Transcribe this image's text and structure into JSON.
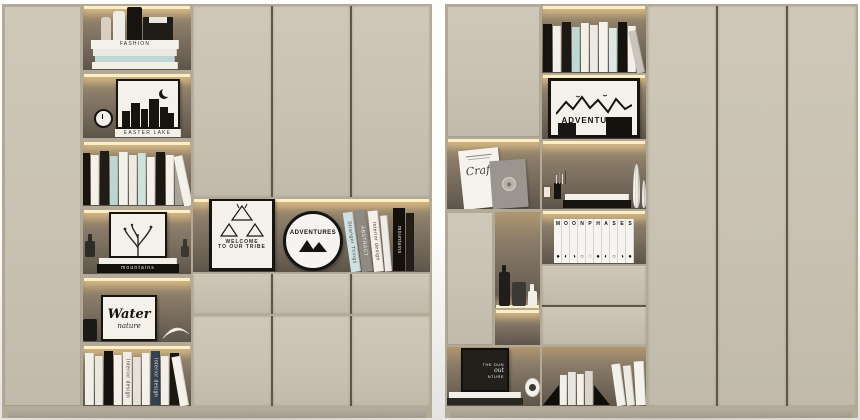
{
  "colors": {
    "bg1": "#fdfdfc",
    "bg2": "#e4e3e1",
    "body_edge": "#b2a996",
    "door": "#c9c2b3",
    "door_hi": "#cfc8b9",
    "door_lo": "#c1baab",
    "gap": "#5e5747",
    "plinth": "#b5ad9e",
    "niche1": "#b0976f",
    "niche2": "#8a7c69",
    "niche3": "#6e6356",
    "niche4": "#5e554a",
    "led": "#ffeec4",
    "ink": "#17130f",
    "paper": "#f4f1eb",
    "teal": "#bfd8d4"
  },
  "scene": {
    "description": "Two beige built-in cabinet units with LED-lit open shelves styled with books and black-and-white decor"
  },
  "texts": {
    "fashion": "FASHION",
    "easter_lake": "EASTER LAKE",
    "mountains": "mountains",
    "water": "Water",
    "nature": "nature",
    "welcome": "WELCOME",
    "to_our_tribe": "TO OUR TRIBE",
    "adventures": "ADVENTURES",
    "craft": "Craft",
    "poster_line1": "THE OUN",
    "poster_line2": "out",
    "poster_line3": "NTURE",
    "moon_row": "M O O N",
    "phases_row": "P H A S E S"
  },
  "left_cabinet": {
    "fashion_stack": [
      {
        "c": "#f5f2ec",
        "h": 9,
        "w": 88,
        "t": "FASHION",
        "tc": "#2e2a25"
      },
      {
        "c": "#ebe8e1",
        "h": 7,
        "w": 84
      },
      {
        "c": "#bfd8d4",
        "h": 6,
        "w": 80
      },
      {
        "c": "#f3f0ea",
        "h": 7,
        "w": 86
      }
    ],
    "easter_spine": [
      {
        "c": "#f3f0ea",
        "h": 8,
        "w": 66,
        "t": "EASTER LAKE",
        "tc": "#35312b"
      }
    ],
    "row3_books": [
      {
        "c": "#17130f",
        "h": 52,
        "w": 9
      },
      {
        "c": "#f4f1eb",
        "h": 50,
        "w": 8
      },
      {
        "c": "#201c17",
        "h": 54,
        "w": 9
      },
      {
        "c": "#bdd6d2",
        "h": 49,
        "w": 8
      },
      {
        "c": "#f4f1eb",
        "h": 53,
        "w": 9
      },
      {
        "c": "#eceae3",
        "h": 50,
        "w": 8
      },
      {
        "c": "#cfe2de",
        "h": 52,
        "w": 8
      },
      {
        "c": "#f4f1eb",
        "h": 48,
        "w": 8
      },
      {
        "c": "#1b1713",
        "h": 53,
        "w": 9
      },
      {
        "c": "#f4f1eb",
        "h": 50,
        "w": 8
      },
      {
        "c": "#a9a49b",
        "h": 47,
        "w": 8
      },
      {
        "c": "#f4f1eb",
        "h": 51,
        "w": 9,
        "r": -12
      }
    ],
    "mountain_stack": [
      {
        "c": "#f2efe9",
        "h": 6,
        "w": 78
      },
      {
        "c": "#14110d",
        "h": 9,
        "w": 82,
        "t": "mountains",
        "tc": "#efece6"
      }
    ],
    "row6_books": [
      {
        "c": "#f2efe9",
        "h": 52,
        "w": 9
      },
      {
        "c": "#eae7e0",
        "h": 49,
        "w": 8
      },
      {
        "c": "#15110e",
        "h": 54,
        "w": 9
      },
      {
        "c": "#f4f1eb",
        "h": 50,
        "w": 8
      },
      {
        "c": "#f0ece5",
        "h": 53,
        "w": 9,
        "t": "Interior design",
        "tc": "#3a3631"
      },
      {
        "c": "#e6e2da",
        "h": 48,
        "w": 8
      },
      {
        "c": "#f4f1eb",
        "h": 52,
        "w": 8
      },
      {
        "c": "#33424e",
        "h": 54,
        "w": 9,
        "t": "Interior design",
        "tc": "#e8e5df"
      },
      {
        "c": "#f2efe9",
        "h": 49,
        "w": 8
      },
      {
        "c": "#1b1713",
        "h": 52,
        "w": 9
      },
      {
        "c": "#f4f1eb",
        "h": 50,
        "w": 9,
        "r": -10
      }
    ],
    "middle_books": [
      {
        "c": "#cfe0e2",
        "h": 60,
        "w": 10,
        "t": "Stranger Things",
        "tc": "#4a4a48",
        "r": -8
      },
      {
        "c": "#8f8b84",
        "h": 62,
        "w": 11,
        "t": "ABSTRACT",
        "tc": "#f0ede7",
        "r": -7
      },
      {
        "c": "#f4f1eb",
        "h": 61,
        "w": 10,
        "t": "Interior design",
        "tc": "#343028",
        "r": -6
      },
      {
        "c": "#efece6",
        "h": 56,
        "w": 7,
        "r": -5
      },
      {
        "c": "#14100c",
        "h": 63,
        "w": 12,
        "t": "mountains",
        "tc": "#efece6"
      },
      {
        "c": "#221e19",
        "h": 58,
        "w": 8
      }
    ]
  },
  "right_cabinet": {
    "top_row_books": [
      {
        "c": "#16120e",
        "h": 48,
        "w": 9
      },
      {
        "c": "#f3f0ea",
        "h": 46,
        "w": 8
      },
      {
        "c": "#1d1914",
        "h": 50,
        "w": 9
      },
      {
        "c": "#bfd8d4",
        "h": 45,
        "w": 8
      },
      {
        "c": "#f3f0ea",
        "h": 49,
        "w": 8
      },
      {
        "c": "#eceae2",
        "h": 47,
        "w": 8
      },
      {
        "c": "#f6f3ed",
        "h": 50,
        "w": 9
      },
      {
        "c": "#dce8e6",
        "h": 44,
        "w": 8
      },
      {
        "c": "#16120e",
        "h": 50,
        "w": 9
      },
      {
        "c": "#f3f0ea",
        "h": 46,
        "w": 8
      },
      {
        "c": "#c9c5bc",
        "h": 43,
        "w": 8,
        "r": -12
      }
    ],
    "vase_stack": [
      {
        "c": "#f4f1eb",
        "h": 6,
        "w": 64
      },
      {
        "c": "#17130f",
        "h": 8,
        "w": 68
      }
    ],
    "moon_binders": [
      {
        "letter": "M",
        "phase": "●"
      },
      {
        "letter": "O",
        "phase": "◐"
      },
      {
        "letter": "O",
        "phase": "◑"
      },
      {
        "letter": "N",
        "phase": "○"
      },
      {
        "letter": "P",
        "phase": "◌"
      },
      {
        "letter": "H",
        "phase": "●"
      },
      {
        "letter": "A",
        "phase": "◐"
      },
      {
        "letter": "S",
        "phase": "○"
      },
      {
        "letter": "E",
        "phase": "◑"
      },
      {
        "letter": "S",
        "phase": "●"
      }
    ],
    "posterA_books": [
      {
        "c": "#f2efe9",
        "h": 6,
        "w": 72
      },
      {
        "c": "#2b2723",
        "h": 7,
        "w": 76
      }
    ],
    "bookend_books": [
      {
        "c": "#f2efe9",
        "h": 30,
        "w": 7
      },
      {
        "c": "#e8e5de",
        "h": 33,
        "w": 8
      },
      {
        "c": "#f4f1eb",
        "h": 31,
        "w": 7
      },
      {
        "c": "#d9d5cd",
        "h": 34,
        "w": 8
      }
    ],
    "lean_books": [
      {
        "c": "#f4f1eb",
        "h": 42,
        "w": 9,
        "r": -8
      },
      {
        "c": "#eceae3",
        "h": 40,
        "w": 8,
        "r": -6
      },
      {
        "c": "#f6f3ed",
        "h": 44,
        "w": 10,
        "r": -3
      }
    ]
  }
}
